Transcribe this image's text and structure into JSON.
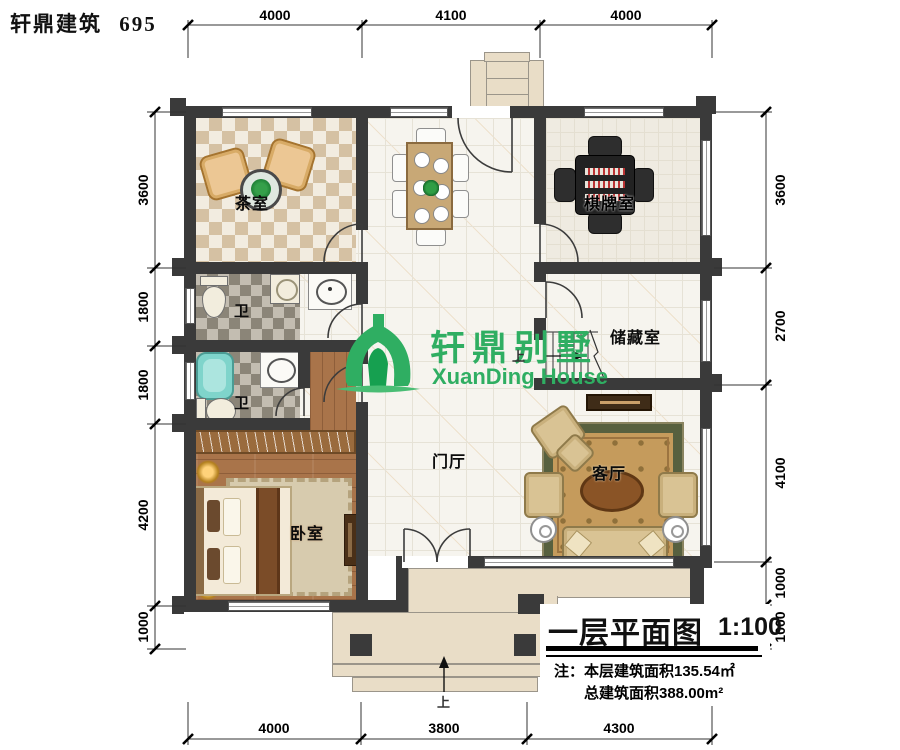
{
  "header": {
    "brand": "轩鼎建筑",
    "number": "695"
  },
  "plan": {
    "rooms": {
      "tea": "茶室",
      "chess": "棋牌室",
      "bath_upper": "卫",
      "bath_lower": "卫",
      "storage": "储藏室",
      "hall": "门厅",
      "living": "客厅",
      "bedroom": "卧室"
    },
    "stair_up": "上",
    "entry_up": "上"
  },
  "watermark": {
    "cn": "轩鼎别墅",
    "en": "XuanDing House"
  },
  "dimensions": {
    "top": [
      "4000",
      "4100",
      "4000"
    ],
    "bottom": [
      "4000",
      "3800",
      "4300"
    ],
    "left": [
      "3600",
      "1800",
      "1800",
      "4200",
      "1000"
    ],
    "right": [
      "3600",
      "2700",
      "4100",
      "1000",
      "1000"
    ]
  },
  "title_block": {
    "title": "一层平面图",
    "scale": "1:100",
    "note_line1": "注：本层建筑面积135.54㎡",
    "note_line2": "总建筑面积388.00m²"
  },
  "colors": {
    "wall": "#3a3a3a",
    "brand_green": "#2fae62",
    "wood_floor": "#a9744a",
    "carpet": "#c59b5c",
    "terrace": "#e9ddc7",
    "bathtub": "#7fd4cb"
  }
}
